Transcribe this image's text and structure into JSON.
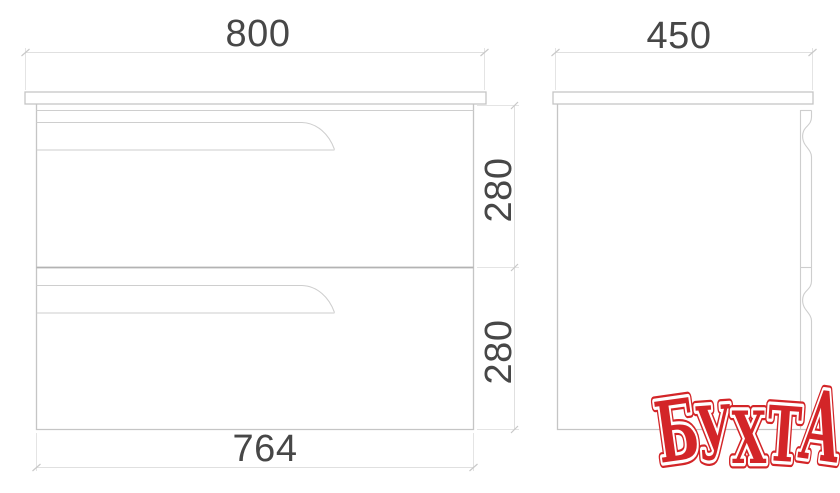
{
  "drawing": {
    "type": "furniture-dimension-diagram",
    "dimensions": {
      "width": "800",
      "depth": "450",
      "drawer1_height": "280",
      "drawer2_height": "280",
      "inner_width": "764"
    }
  },
  "logo": {
    "text": "БУХТА",
    "letters": [
      "Б",
      "У",
      "Х",
      "Т",
      "А"
    ],
    "color": "#d32528",
    "outline_color": "#ffffff"
  },
  "colors": {
    "background": "#ffffff",
    "outline": "#c5c5c5",
    "divider": "#b3b3b3",
    "dimension_line": "#e0e0e0",
    "dimension_text": "#474747"
  }
}
